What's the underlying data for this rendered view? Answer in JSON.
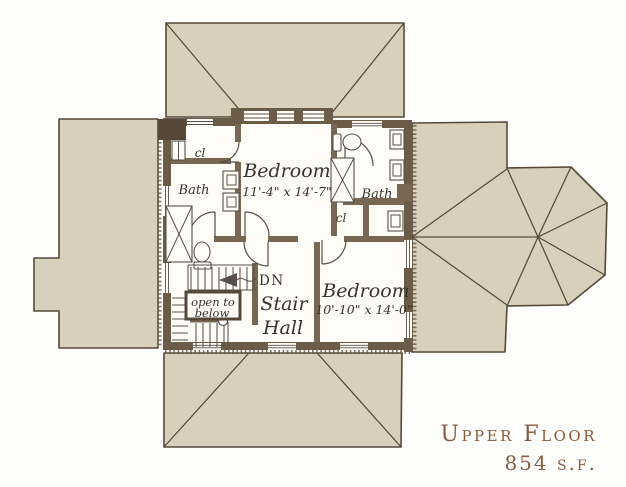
{
  "plan": {
    "bedroom1": {
      "name": "Bedroom",
      "dims": "11'-4\" x 14'-7\""
    },
    "bedroom2": {
      "name": "Bedroom",
      "dims": "10'-10\" x 14'-0\""
    },
    "stair_hall": {
      "line1": "Stair",
      "line2": "Hall"
    },
    "bath_left": "Bath",
    "bath_right": "Bath",
    "closet_left": "cl",
    "closet_right": "cl",
    "open_below": {
      "line1": "open to",
      "line2": "below"
    },
    "down_label": "DN"
  },
  "title": {
    "floor_name": "Upper Floor",
    "area": "854 s.f."
  },
  "colors": {
    "roof_fill": "#d9d0bb",
    "roof_line": "#57493a",
    "wall_ext": "#6b5c47",
    "wall_int": "#786752",
    "chimney": "#564839",
    "floor": "#fdfcf6",
    "line": "#57504a",
    "label": "#38332c",
    "title": "#8a5b3a",
    "bg": "#fefefd"
  }
}
